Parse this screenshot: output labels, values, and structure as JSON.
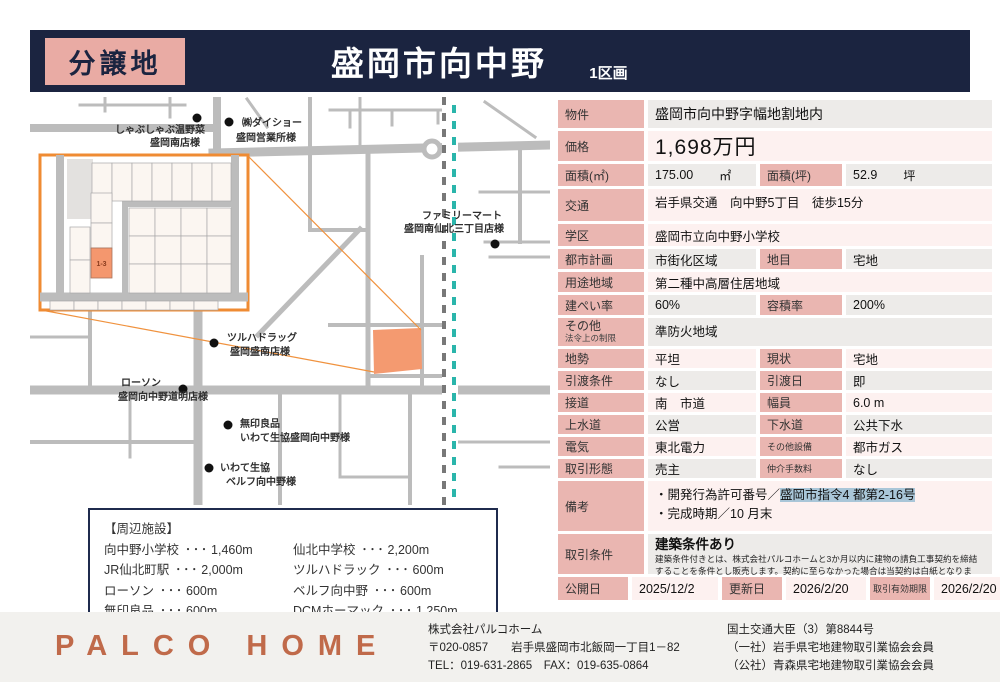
{
  "header": {
    "badge": "分譲地",
    "title": "盛岡市向中野",
    "subtitle": "1区画"
  },
  "map": {
    "lot_label": "1-3",
    "pois": [
      {
        "line1": "しゃぶしゃぶ温野菜",
        "line2": "盛岡南店様"
      },
      {
        "line1": "㈱ダイショー",
        "line2": "盛岡営業所様"
      },
      {
        "line1": "ファミリーマート",
        "line2": "盛岡南仙北三丁目店様"
      },
      {
        "line1": "ツルハドラッグ",
        "line2": "盛岡盛南店様"
      },
      {
        "line1": "ローソン",
        "line2": "盛岡向中野道明店様"
      },
      {
        "line1": "無印良品",
        "line2": "いわて生協盛岡向中野様"
      },
      {
        "line1": "いわて生協",
        "line2": "ベルフ向中野様"
      }
    ]
  },
  "facilities": {
    "title": "【周辺施設】",
    "sep": "・・・",
    "left": [
      {
        "name": "向中野小学校",
        "distance": "1,460m"
      },
      {
        "name": "JR仙北町駅",
        "distance": "2,000m"
      },
      {
        "name": "ローソン",
        "distance": "600m"
      },
      {
        "name": "無印良品",
        "distance": "600m"
      }
    ],
    "right": [
      {
        "name": "仙北中学校",
        "distance": "2,200m"
      },
      {
        "name": "ツルハドラック",
        "distance": "600m"
      },
      {
        "name": "ベルフ向中野",
        "distance": "600m"
      },
      {
        "name": "DCMホーマック",
        "distance": "1,250m"
      }
    ]
  },
  "table": {
    "bukken": {
      "label": "物件",
      "value": "盛岡市向中野字幅地割地内"
    },
    "kakaku": {
      "label": "価格",
      "value": "1,698万円"
    },
    "menseki_m2": {
      "label": "面積(㎡)",
      "value": "175.00",
      "unit": "㎡"
    },
    "menseki_tsubo": {
      "label": "面積(坪)",
      "value": "52.9",
      "unit": "坪"
    },
    "kotsu": {
      "label": "交通",
      "value": "岩手県交通　向中野5丁目　徒歩15分"
    },
    "gakku": {
      "label": "学区",
      "value": "盛岡市立向中野小学校"
    },
    "toshikeikaku": {
      "label": "都市計画",
      "value": "市街化区域"
    },
    "chimoku": {
      "label": "地目",
      "value": "宅地"
    },
    "yotochiiki": {
      "label": "用途地域",
      "value": "第二種中高層住居地域"
    },
    "kenpei": {
      "label": "建ぺい率",
      "value": "60%"
    },
    "yoseki": {
      "label": "容積率",
      "value": "200%"
    },
    "sonota_hosei": {
      "label": "その他",
      "sublabel": "法令上の制限",
      "value": "準防火地域"
    },
    "chisei": {
      "label": "地勢",
      "value": "平坦"
    },
    "genjo": {
      "label": "現状",
      "value": "宅地"
    },
    "hikiwatashi_joken": {
      "label": "引渡条件",
      "value": "なし"
    },
    "hikiwatashi_bi": {
      "label": "引渡日",
      "value": "即"
    },
    "setsudo": {
      "label": "接道",
      "value": "南　市道"
    },
    "fukuin": {
      "label": "幅員",
      "value": "6.0 m"
    },
    "josui": {
      "label": "上水道",
      "value": "公営"
    },
    "gesui": {
      "label": "下水道",
      "value": "公共下水"
    },
    "denki": {
      "label": "電気",
      "value": "東北電力"
    },
    "sonota_setsubi": {
      "label": "その他設備",
      "value": "都市ガス"
    },
    "torihiki_keitai": {
      "label": "取引形態",
      "value": "売主"
    },
    "chukai": {
      "label": "仲介手数料",
      "value": "なし"
    },
    "biko": {
      "label": "備考",
      "line1_prefix": "・開発行為許可番号／",
      "line1_highlight": "盛岡市指令4 都第2‐16号",
      "line2": "・完成時期／10 月末"
    },
    "torihiki_joken": {
      "label": "取引条件",
      "value": "建築条件あり",
      "note": "建築条件付きとは、株式会社パルコホームと3か月以内に建物の請負工事契約を締結することを条件とし販売します。契約に至らなかった場合は当契約は白紙となります。"
    },
    "kokaibi": {
      "label": "公開日",
      "value": "2025/12/2"
    },
    "koshinbi": {
      "label": "更新日",
      "value": "2026/2/20"
    },
    "yuko_kigen": {
      "label": "取引有効期限",
      "value": "2026/2/20"
    }
  },
  "footer": {
    "logo": "PALCO HOME",
    "company": "株式会社パルコホーム",
    "address": "〒020-0857　　岩手県盛岡市北飯岡一丁目1－82",
    "tel_fax": "TEL：019-631-2865　FAX：019-635-0864",
    "license": "国土交通大臣（3）第8844号",
    "member1": "（一社）岩手県宅地建物取引業協会会員",
    "member2": "（公社）青森県宅地建物取引業協会会員"
  },
  "colors": {
    "navy": "#1b2440",
    "badge_pink": "#e9aba4",
    "header_pink": "#eab6b1",
    "row_pink": "#fdf1f0",
    "row_gray": "#edebe9",
    "highlight_blue": "#a9c6d8",
    "inset_orange": "#ef8b33",
    "lot_orange": "#f4976e",
    "rail_teal": "#2ab5ab",
    "logo_terracotta": "#c06a4a"
  }
}
